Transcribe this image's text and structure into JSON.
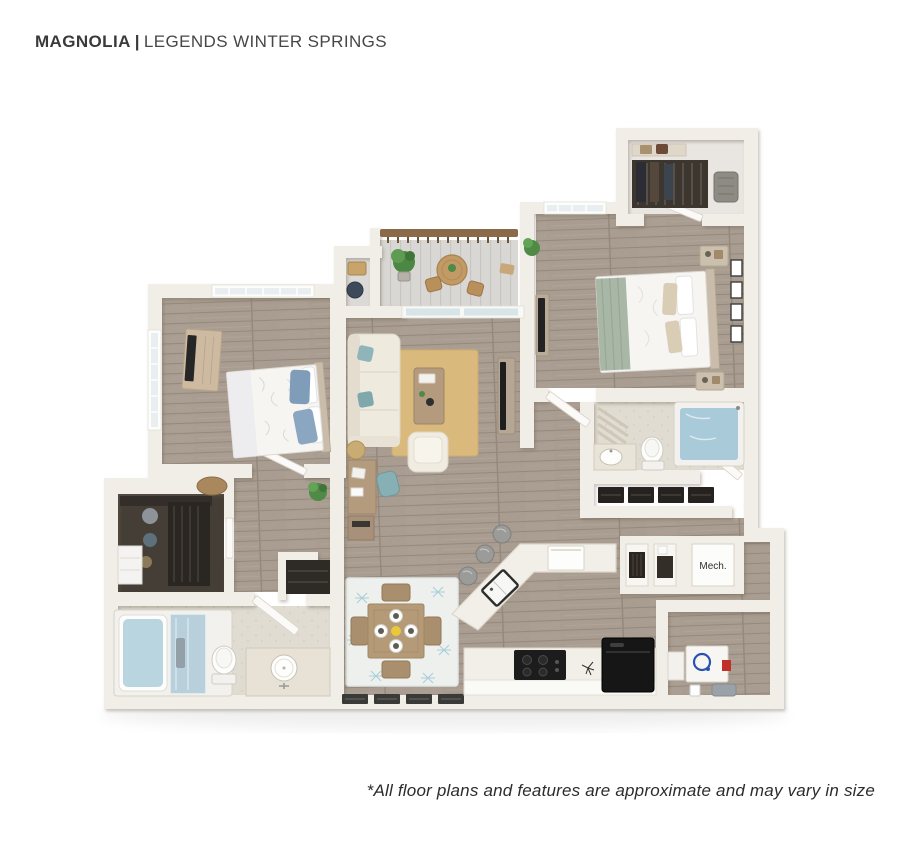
{
  "header": {
    "title_primary": "MAGNOLIA",
    "separator": "|",
    "title_secondary": "LEGENDS WINTER SPRINGS"
  },
  "footer": {
    "disclaimer": "*All floor plans and features are approximate and may vary in size"
  },
  "floor_plan": {
    "labels": {
      "mechanical_room": "Mech."
    },
    "colors": {
      "wall": "#f1eee7",
      "floor_wood": "#a89d90",
      "floor_balcony": "#d9d7d3",
      "bath_tile": "#e0dcd2",
      "closet_interior": "#453e36",
      "rug_living": "#d9ba7c",
      "rug_dining": "#eef0ee",
      "rug_dining_pattern": "#a9ced8",
      "sofa_cream": "#efeade",
      "accent_teal": "#8fb5ba",
      "bed_blanket_sage": "#a9b7a6",
      "pillow_blue": "#7f9db8",
      "water_blue": "#a9cbd9",
      "wood_furniture": "#b49b7d",
      "railing_wood": "#8a6a48",
      "appliance_black": "#1c1c1c",
      "stool_gray": "#9b9b99",
      "washer_blue": "#2a52b0",
      "accent_red": "#c03028",
      "text_dark": "#3a3a3a"
    }
  }
}
